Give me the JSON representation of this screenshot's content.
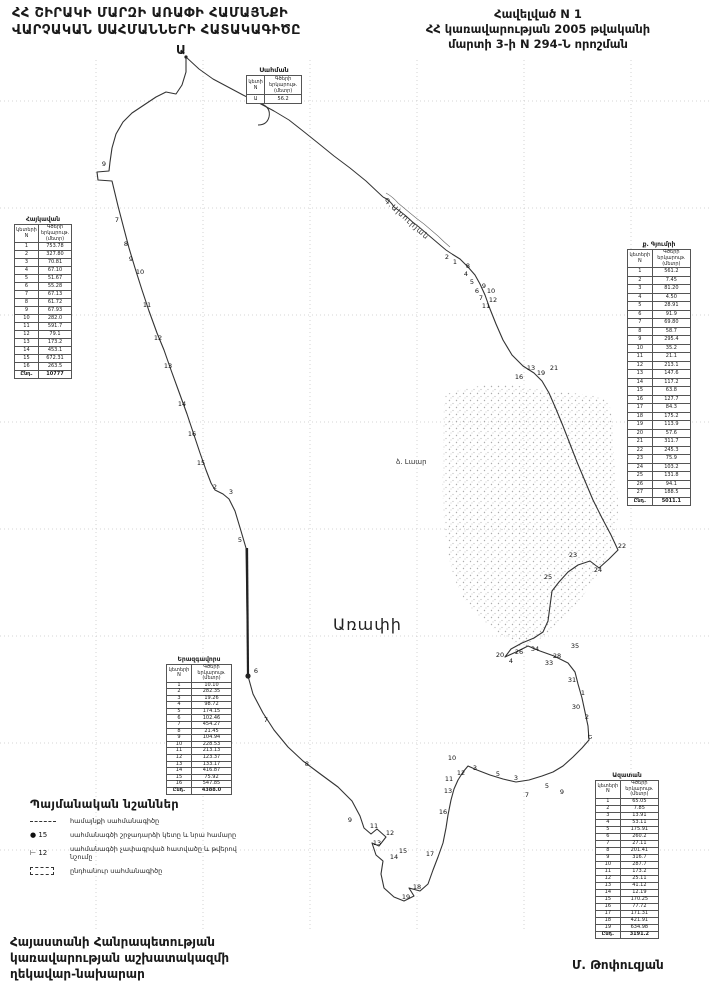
{
  "doc": {
    "title_line1": "ՀՀ ՇԻՐԱԿԻ ՄԱՐԶԻ ԱՌԱՓԻ ՀԱՄԱՅՆՔԻ",
    "title_line2": "ՎԱՐՉԱԿԱՆ ՍԱՀՄԱՆՆԵՐԻ ՀԱՏԱԿԱԳԻԾԸ",
    "annex_line1": "Հավելված N 1",
    "annex_line2": "ՀՀ կառավարության 2005 թվականի",
    "annex_line3": "մարտի 3-ի N 294-Ն որոշման",
    "footer_left_line1": "Հայաստանի Հանրապետության",
    "footer_left_line2": "կառավարության աշխատակազմի",
    "footer_left_line3": "ղեկավար-նախարար",
    "signature": "Մ. Թոփուզյան"
  },
  "colors": {
    "ink": "#1a1a1a",
    "grid": "#c9c9c9",
    "boundary": "#333333"
  },
  "map": {
    "community_label": "Առափի",
    "start_point_label": "Ա",
    "river_label": "Գ.Ախուրյան",
    "lake_label": "ձ. Լաար",
    "points": [
      {
        "n": "9",
        "x": 104,
        "y": 164
      },
      {
        "n": "7",
        "x": 117,
        "y": 220
      },
      {
        "n": "8",
        "x": 126,
        "y": 244
      },
      {
        "n": "9",
        "x": 131,
        "y": 259
      },
      {
        "n": "10",
        "x": 140,
        "y": 272
      },
      {
        "n": "11",
        "x": 147,
        "y": 305
      },
      {
        "n": "12",
        "x": 158,
        "y": 338
      },
      {
        "n": "13",
        "x": 168,
        "y": 366
      },
      {
        "n": "14",
        "x": 182,
        "y": 404
      },
      {
        "n": "16",
        "x": 192,
        "y": 434
      },
      {
        "n": "15",
        "x": 201,
        "y": 463
      },
      {
        "n": "2",
        "x": 215,
        "y": 487
      },
      {
        "n": "3",
        "x": 231,
        "y": 492
      },
      {
        "n": "5",
        "x": 240,
        "y": 540
      },
      {
        "n": "6",
        "x": 256,
        "y": 671
      },
      {
        "n": "7",
        "x": 266,
        "y": 720
      },
      {
        "n": "8",
        "x": 307,
        "y": 764
      },
      {
        "n": "9",
        "x": 350,
        "y": 820
      },
      {
        "n": "11",
        "x": 374,
        "y": 826
      },
      {
        "n": "12",
        "x": 390,
        "y": 833
      },
      {
        "n": "13",
        "x": 377,
        "y": 843
      },
      {
        "n": "14",
        "x": 394,
        "y": 857
      },
      {
        "n": "15",
        "x": 403,
        "y": 851
      },
      {
        "n": "17",
        "x": 430,
        "y": 854
      },
      {
        "n": "18",
        "x": 417,
        "y": 887
      },
      {
        "n": "19",
        "x": 406,
        "y": 897
      },
      {
        "n": "16",
        "x": 443,
        "y": 812
      },
      {
        "n": "10",
        "x": 452,
        "y": 758
      },
      {
        "n": "11",
        "x": 449,
        "y": 779
      },
      {
        "n": "12",
        "x": 461,
        "y": 773
      },
      {
        "n": "13",
        "x": 448,
        "y": 791
      },
      {
        "n": "3",
        "x": 475,
        "y": 768
      },
      {
        "n": "5",
        "x": 498,
        "y": 774
      },
      {
        "n": "3",
        "x": 516,
        "y": 778
      },
      {
        "n": "7",
        "x": 527,
        "y": 795
      },
      {
        "n": "5",
        "x": 547,
        "y": 786
      },
      {
        "n": "9",
        "x": 562,
        "y": 792
      },
      {
        "n": "Ե",
        "x": 590,
        "y": 737
      },
      {
        "n": "30",
        "x": 576,
        "y": 707
      },
      {
        "n": "2",
        "x": 587,
        "y": 717
      },
      {
        "n": "31",
        "x": 572,
        "y": 680
      },
      {
        "n": "35",
        "x": 575,
        "y": 646
      },
      {
        "n": "1",
        "x": 583,
        "y": 693
      },
      {
        "n": "20",
        "x": 500,
        "y": 655
      },
      {
        "n": "4",
        "x": 511,
        "y": 661
      },
      {
        "n": "26",
        "x": 519,
        "y": 652
      },
      {
        "n": "34",
        "x": 535,
        "y": 649
      },
      {
        "n": "28",
        "x": 557,
        "y": 656
      },
      {
        "n": "33",
        "x": 549,
        "y": 663
      },
      {
        "n": "25",
        "x": 548,
        "y": 577
      },
      {
        "n": "23",
        "x": 573,
        "y": 555
      },
      {
        "n": "24",
        "x": 598,
        "y": 570
      },
      {
        "n": "22",
        "x": 622,
        "y": 546
      },
      {
        "n": "21",
        "x": 554,
        "y": 368
      },
      {
        "n": "19",
        "x": 541,
        "y": 373
      },
      {
        "n": "13",
        "x": 531,
        "y": 368
      },
      {
        "n": "16",
        "x": 519,
        "y": 377
      },
      {
        "n": "11",
        "x": 486,
        "y": 306
      },
      {
        "n": "12",
        "x": 493,
        "y": 300
      },
      {
        "n": "10",
        "x": 491,
        "y": 291
      },
      {
        "n": "9",
        "x": 484,
        "y": 286
      },
      {
        "n": "8",
        "x": 468,
        "y": 266
      },
      {
        "n": "2",
        "x": 447,
        "y": 257
      },
      {
        "n": "1",
        "x": 455,
        "y": 262
      },
      {
        "n": "4",
        "x": 466,
        "y": 274
      },
      {
        "n": "5",
        "x": 472,
        "y": 282
      },
      {
        "n": "6",
        "x": 477,
        "y": 291
      },
      {
        "n": "7",
        "x": 481,
        "y": 298
      }
    ]
  },
  "tables": {
    "top": {
      "title": "Սահման",
      "col_n": "կետի N",
      "col_len": "Գծերի երկարութ. (մետր)",
      "rows": [
        [
          "Ա",
          "56.2"
        ]
      ],
      "total": null
    },
    "left": {
      "title": "Հայկավան",
      "col_n": "կետերի N",
      "col_len": "Գծերի երկարութ. (մետր)",
      "rows": [
        [
          "1",
          "753.78"
        ],
        [
          "2",
          "327.80"
        ],
        [
          "3",
          "70.81"
        ],
        [
          "4",
          "67.10"
        ],
        [
          "5",
          "51.67"
        ],
        [
          "6",
          "55.28"
        ],
        [
          "7",
          "67.13"
        ],
        [
          "8",
          "61.72"
        ],
        [
          "9",
          "67.93"
        ],
        [
          "10",
          "282.0"
        ],
        [
          "11",
          "591.7"
        ],
        [
          "12",
          "79.1"
        ],
        [
          "13",
          "173.2"
        ],
        [
          "14",
          "453.1"
        ],
        [
          "15",
          "672.31"
        ],
        [
          "16",
          "263.5"
        ]
      ],
      "total": [
        "Ընդ.",
        "10777"
      ]
    },
    "right": {
      "title": "ք. Գյումրի",
      "col_n": "կետերի N",
      "col_len": "Գծերի երկարութ. (մետր)",
      "rows": [
        [
          "1",
          "561.2"
        ],
        [
          "2",
          "7.45"
        ],
        [
          "3",
          "81.20"
        ],
        [
          "4",
          "4.50"
        ],
        [
          "5",
          "28.91"
        ],
        [
          "6",
          "91.9"
        ],
        [
          "7",
          "69.80"
        ],
        [
          "8",
          "58.7"
        ],
        [
          "9",
          "295.4"
        ],
        [
          "10",
          "35.2"
        ],
        [
          "11",
          "21.1"
        ],
        [
          "12",
          "213.1"
        ],
        [
          "13",
          "147.6"
        ],
        [
          "14",
          "117.2"
        ],
        [
          "15",
          "63.8"
        ],
        [
          "16",
          "127.7"
        ],
        [
          "17",
          "84.3"
        ],
        [
          "18",
          "175.2"
        ],
        [
          "19",
          "113.9"
        ],
        [
          "20",
          "57.6"
        ],
        [
          "21",
          "311.7"
        ],
        [
          "22",
          "245.3"
        ],
        [
          "23",
          "75.9"
        ],
        [
          "24",
          "103.2"
        ],
        [
          "25",
          "131.8"
        ],
        [
          "26",
          "94.1"
        ],
        [
          "27",
          "188.5"
        ]
      ],
      "total": [
        "Ընդ.",
        "5011.1"
      ]
    },
    "center": {
      "title": "Երազգավորս",
      "col_n": "կետերի N",
      "col_len": "Գծերի երկարութ. (մետր)",
      "rows": [
        [
          "1",
          "10.10"
        ],
        [
          "2",
          "282.35"
        ],
        [
          "3",
          "19.26"
        ],
        [
          "4",
          "98.72"
        ],
        [
          "5",
          "174.15"
        ],
        [
          "6",
          "102.46"
        ],
        [
          "7",
          "454.27"
        ],
        [
          "8",
          "21.45"
        ],
        [
          "9",
          "104.94"
        ],
        [
          "10",
          "228.53"
        ],
        [
          "11",
          "213.13"
        ],
        [
          "12",
          "123.37"
        ],
        [
          "13",
          "133.17"
        ],
        [
          "14",
          "416.87"
        ],
        [
          "15",
          "75.92"
        ],
        [
          "16",
          "547.85"
        ]
      ],
      "total": [
        "Ընդ.",
        "4388.0"
      ]
    },
    "bottom_right": {
      "title": "Ազատան",
      "col_n": "կետերի N",
      "col_len": "Գծերի երկարութ. (մետր)",
      "rows": [
        [
          "1",
          "65.05"
        ],
        [
          "2",
          "7.85"
        ],
        [
          "3",
          "13.91"
        ],
        [
          "4",
          "53.11"
        ],
        [
          "5",
          "175.91"
        ],
        [
          "6",
          "260.2"
        ],
        [
          "7",
          "27.11"
        ],
        [
          "8",
          "201.41"
        ],
        [
          "9",
          "316.7"
        ],
        [
          "10",
          "287.7"
        ],
        [
          "11",
          "173.2"
        ],
        [
          "12",
          "25.11"
        ],
        [
          "13",
          "41.12"
        ],
        [
          "14",
          "12.19"
        ],
        [
          "15",
          "170.25"
        ],
        [
          "16",
          "77.72"
        ],
        [
          "17",
          "171.31"
        ],
        [
          "18",
          "421.91"
        ],
        [
          "19",
          "634.98"
        ]
      ],
      "total": [
        "Ընդ.",
        "3191.2"
      ]
    }
  },
  "legend": {
    "title": "Պայմանական նշաններ",
    "items": [
      {
        "symbol": "dash-line",
        "symbol_text": "",
        "label": "համայնքի սահմանագիծը"
      },
      {
        "symbol": "text",
        "symbol_text": "● 15",
        "label": "սահմանագծի շրջադարձի կետը և նրա համարը"
      },
      {
        "symbol": "text",
        "symbol_text": "⊢ 12",
        "label": "սահմանագծի չափագրված հատվածը և թվերով նշումը"
      },
      {
        "symbol": "dash-box",
        "symbol_text": "",
        "label": "ընդհանուր սահմանագիծը"
      }
    ]
  }
}
